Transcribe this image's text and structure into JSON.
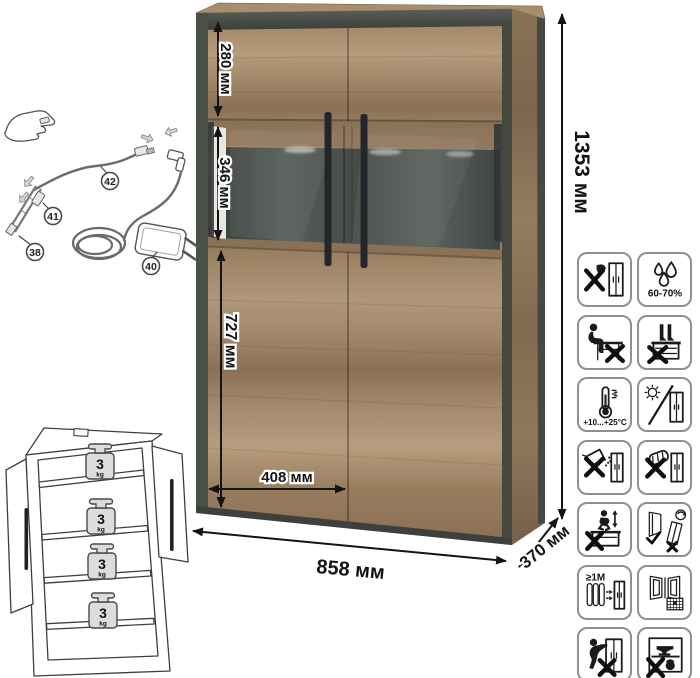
{
  "product": {
    "type_note": "display cabinet spec sheet",
    "colors": {
      "wood_light": "#b59c7d",
      "wood_dark": "#8a7156",
      "frame_dark": "#4a4e49",
      "interior_slate": "#474e4b",
      "annotation": "#141414"
    }
  },
  "dimensions": {
    "top_section": "280 мм",
    "display_section": "346 мм",
    "lower_section": "727 мм",
    "door_width": "408 мм",
    "total_width": "858 мм",
    "depth": "370 мм",
    "total_height": "1353 мм"
  },
  "wiring_diagram": {
    "part_numbers": {
      "led_strip": "38",
      "power_adapter": "40",
      "strip_connector": "41",
      "connection_cable": "42"
    }
  },
  "shelf_load": {
    "weights": [
      {
        "value": "3",
        "unit": "kg"
      },
      {
        "value": "3",
        "unit": "kg"
      },
      {
        "value": "3",
        "unit": "kg"
      },
      {
        "value": "3",
        "unit": "kg"
      }
    ]
  },
  "care_icons": [
    {
      "name": "no-sharp-tools-icon"
    },
    {
      "name": "humidity-icon",
      "text": "60-70%"
    },
    {
      "name": "no-sitting-icon"
    },
    {
      "name": "no-standing-icon"
    },
    {
      "name": "temperature-icon",
      "text": "+10...+25°C"
    },
    {
      "name": "no-direct-sunlight-icon"
    },
    {
      "name": "no-abrasives-icon"
    },
    {
      "name": "no-scouring-icon"
    },
    {
      "name": "no-jumping-icon"
    },
    {
      "name": "adjust-doors-icon"
    },
    {
      "name": "heater-distance-icon",
      "text": "≥1M"
    },
    {
      "name": "ventilate-room-icon"
    },
    {
      "name": "no-dragging-icon"
    },
    {
      "name": "no-heavy-load-icon"
    }
  ]
}
